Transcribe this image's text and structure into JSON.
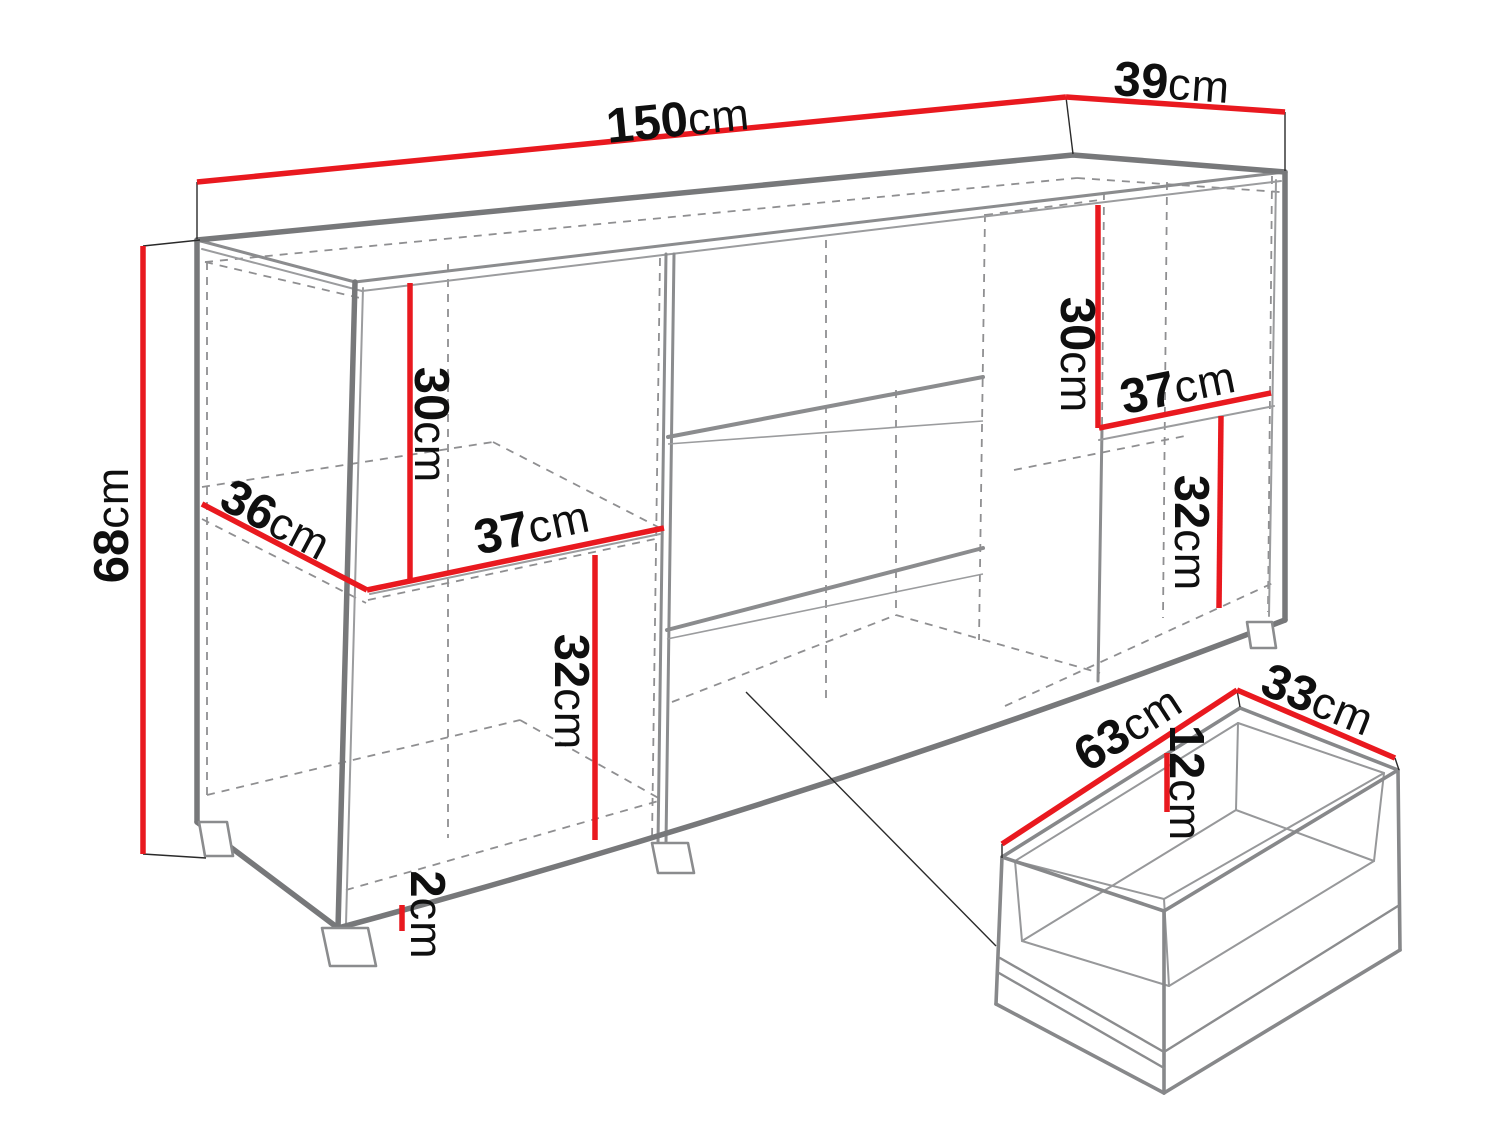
{
  "diagram": {
    "type": "furniture-dimension-drawing",
    "subject": "sideboard carcass with pulled-out drawer detail",
    "unit": "cm",
    "colors": {
      "accent": "#e9191f",
      "outline": "#77787a",
      "hidden": "#8f8f91",
      "text": "#0f0f0f",
      "background": "#ffffff"
    },
    "labels": [
      {
        "id": "overall-width",
        "value": "150",
        "unit": "cm"
      },
      {
        "id": "overall-depth",
        "value": "39",
        "unit": "cm"
      },
      {
        "id": "overall-height",
        "value": "68",
        "unit": "cm"
      },
      {
        "id": "left-shelf-depth",
        "value": "36",
        "unit": "cm"
      },
      {
        "id": "left-shelf-width",
        "value": "37",
        "unit": "cm"
      },
      {
        "id": "left-upper-height",
        "value": "30",
        "unit": "cm"
      },
      {
        "id": "left-lower-height",
        "value": "32",
        "unit": "cm"
      },
      {
        "id": "plinth-height",
        "value": "2",
        "unit": "cm"
      },
      {
        "id": "right-upper-height",
        "value": "30",
        "unit": "cm"
      },
      {
        "id": "right-shelf-width",
        "value": "37",
        "unit": "cm"
      },
      {
        "id": "right-lower-height",
        "value": "32",
        "unit": "cm"
      },
      {
        "id": "drawer-width",
        "value": "63",
        "unit": "cm"
      },
      {
        "id": "drawer-depth",
        "value": "33",
        "unit": "cm"
      },
      {
        "id": "drawer-inner-height",
        "value": "12",
        "unit": "cm"
      }
    ]
  }
}
